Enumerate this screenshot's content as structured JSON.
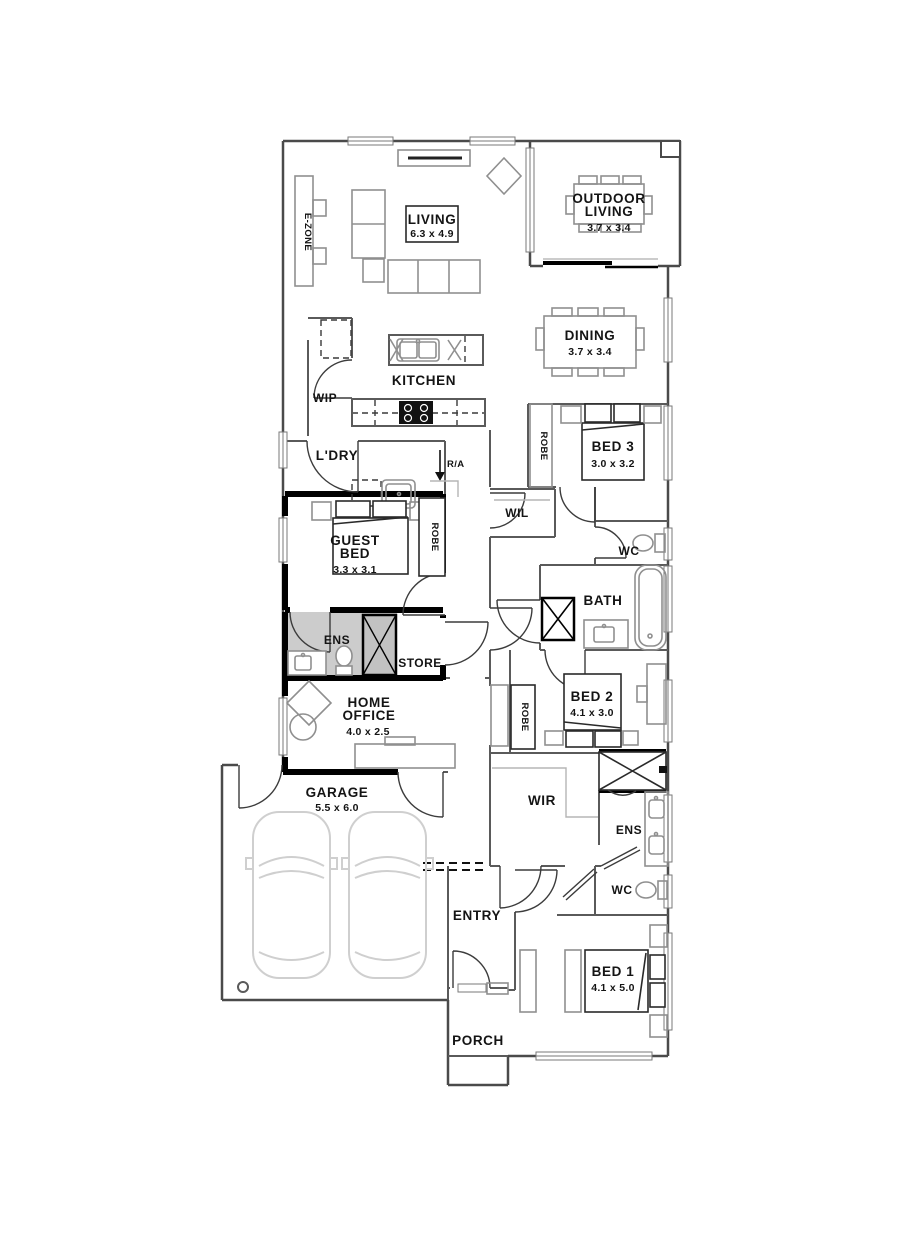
{
  "colors": {
    "wall": "#4a4a4a",
    "thick_wall": "#000000",
    "furniture": "#8f8f8f",
    "light_furniture": "#cfcfcf",
    "ens_floor": "#cccccc",
    "text": "#141414"
  },
  "rooms": {
    "e_zone": {
      "label": "E-ZONE"
    },
    "living": {
      "label": "LIVING",
      "dim": "6.3 x 4.9"
    },
    "outdoor_living": {
      "label_line1": "OUTDOOR",
      "label_line2": "LIVING",
      "dim": "3.7 x 3.4"
    },
    "dining": {
      "label": "DINING",
      "dim": "3.7 x 3.4"
    },
    "kitchen": {
      "label": "KITCHEN"
    },
    "wip": {
      "label": "WIP"
    },
    "ldry": {
      "label": "L'DRY"
    },
    "return_air": {
      "label": "R/A"
    },
    "bed3": {
      "label": "BED 3",
      "dim": "3.0 x 3.2",
      "robe": "ROBE"
    },
    "guest_bed": {
      "label_line1": "GUEST",
      "label_line2": "BED",
      "dim": "3.3 x 3.1",
      "robe": "ROBE"
    },
    "wil": {
      "label": "WIL"
    },
    "wc_main": {
      "label": "WC"
    },
    "bath": {
      "label": "BATH"
    },
    "ens_guest": {
      "label": "ENS"
    },
    "store": {
      "label": "STORE"
    },
    "home_office": {
      "label_line1": "HOME",
      "label_line2": "OFFICE",
      "dim": "4.0 x 2.5"
    },
    "bed2": {
      "label": "BED 2",
      "dim": "4.1 x 3.0",
      "robe": "ROBE"
    },
    "garage": {
      "label": "GARAGE",
      "dim": "5.5 x 6.0"
    },
    "wir": {
      "label": "WIR"
    },
    "ens_master": {
      "label": "ENS"
    },
    "wc_master": {
      "label": "WC"
    },
    "entry": {
      "label": "ENTRY"
    },
    "bed1": {
      "label": "BED 1",
      "dim": "4.1 x 5.0"
    },
    "porch": {
      "label": "PORCH"
    }
  }
}
